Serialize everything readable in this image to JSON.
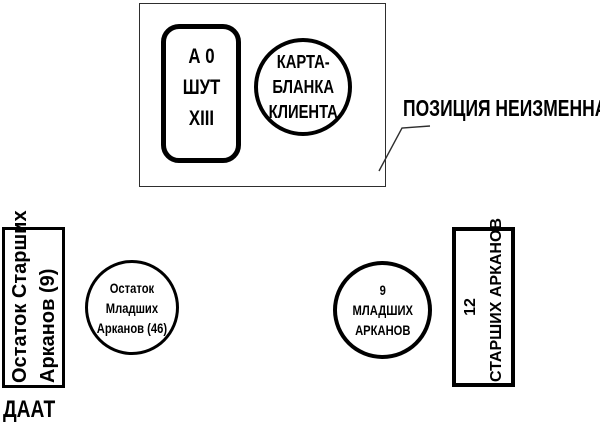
{
  "palette": {
    "ink": "#000000",
    "thin_line": "#2e2e2e",
    "background": "#ffffff"
  },
  "fixed_panel": {
    "card": {
      "line1": "А 0",
      "line2": "ШУТ",
      "line3": "XIII"
    },
    "client_circle": {
      "line1": "КАРТА-",
      "line2": "БЛАНКА",
      "line3": "КЛИЕНТА"
    }
  },
  "callout": {
    "label": "ПОЗИЦИЯ НЕИЗМЕННА"
  },
  "left_stack": {
    "box": {
      "line1": "Остаток Старших",
      "line2": "Арканов (9)"
    },
    "caption": "ДААТ"
  },
  "minor_remainder_circle": {
    "line1": "Остаток",
    "line2": "Младших",
    "line3": "Арканов (46)"
  },
  "nine_minor_circle": {
    "line1": "9",
    "line2": "МЛАДШИХ",
    "line3": "АРКАНОВ"
  },
  "right_box": {
    "line1": "12",
    "line2": "СТАРШИХ АРКАНОВ"
  }
}
